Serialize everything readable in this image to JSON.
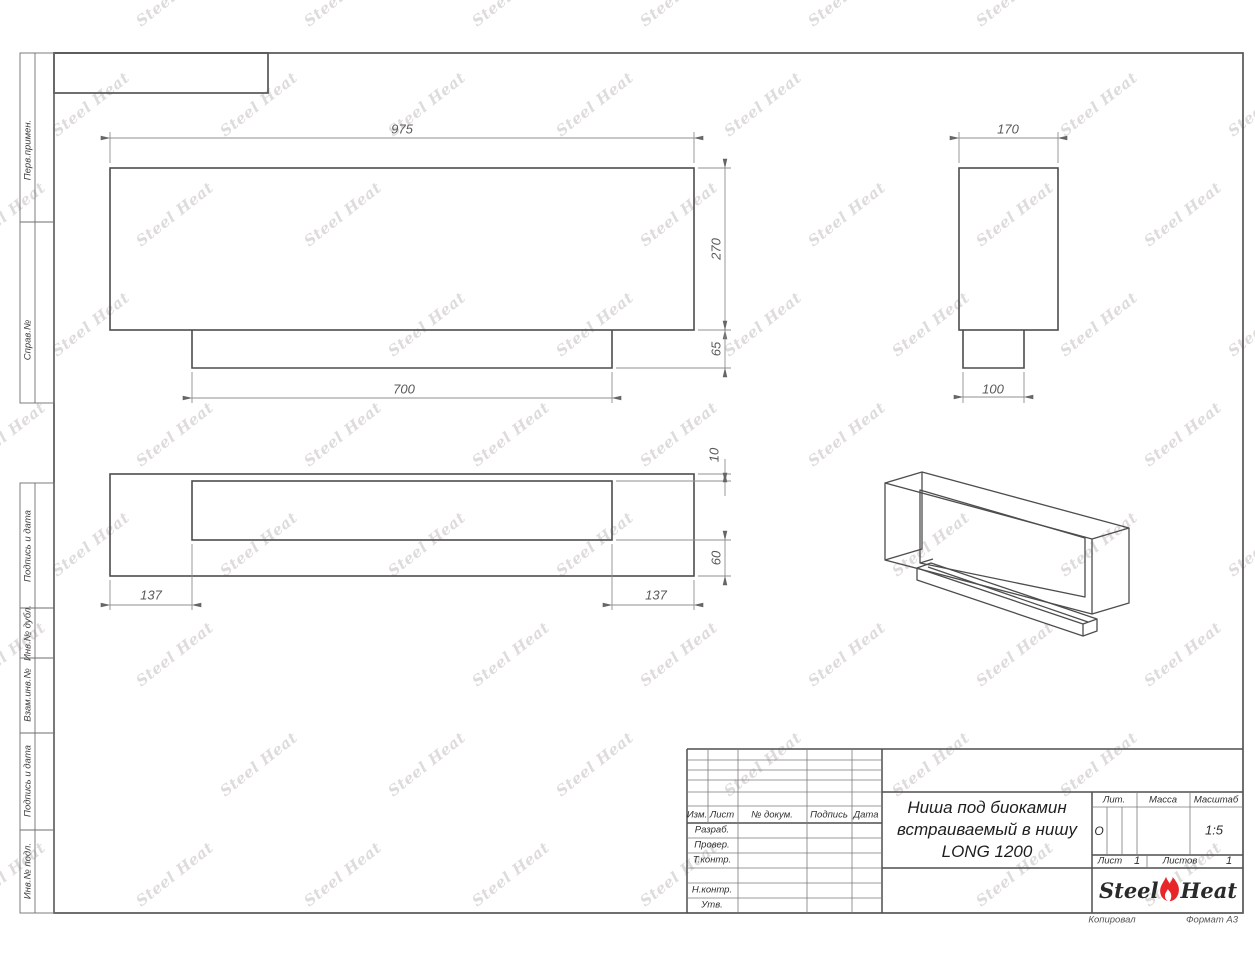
{
  "watermark": {
    "text": "Steel Heat"
  },
  "sheet": {
    "copied_label": "Копировал",
    "format_label": "Формат А3"
  },
  "side_labels": [
    "Перв.примен.",
    "Справ.№",
    "Подпись и дата",
    "Инв.№ дубл.",
    "Взам.инв.№",
    "Подпись и дата",
    "Инв.№ подл."
  ],
  "dims": {
    "overall_width": "975",
    "overall_height": "270",
    "base_height": "65",
    "base_width": "700",
    "overall_depth": "170",
    "base_depth": "100",
    "wall_front": "10",
    "wall_back": "60",
    "side_offset_left": "137",
    "side_offset_right": "137"
  },
  "title_block": {
    "columns": {
      "izm": "Изм.",
      "list": "Лист",
      "doc_no": "№ докум.",
      "sign": "Подпись",
      "date": "Дата"
    },
    "rows": {
      "developed": "Разраб.",
      "checked": "Провер.",
      "tcontrol": "Т.контр.",
      "ncontrol": "Н.контр.",
      "approved": "Утв."
    },
    "title_line1": "Ниша под биокамин",
    "title_line2": "встраиваемый в нишу",
    "title_line3": "LONG 1200",
    "lit_label": "Лит.",
    "mass_label": "Масса",
    "scale_label": "Масштаб",
    "lit_value": "О",
    "scale_value": "1:5",
    "sheet_label": "Лист",
    "sheet_value": "1",
    "sheets_label": "Листов",
    "sheets_value": "1",
    "brand": {
      "part1": "Steel",
      "part2": "Heat",
      "flame_color": "#e8262a"
    }
  }
}
